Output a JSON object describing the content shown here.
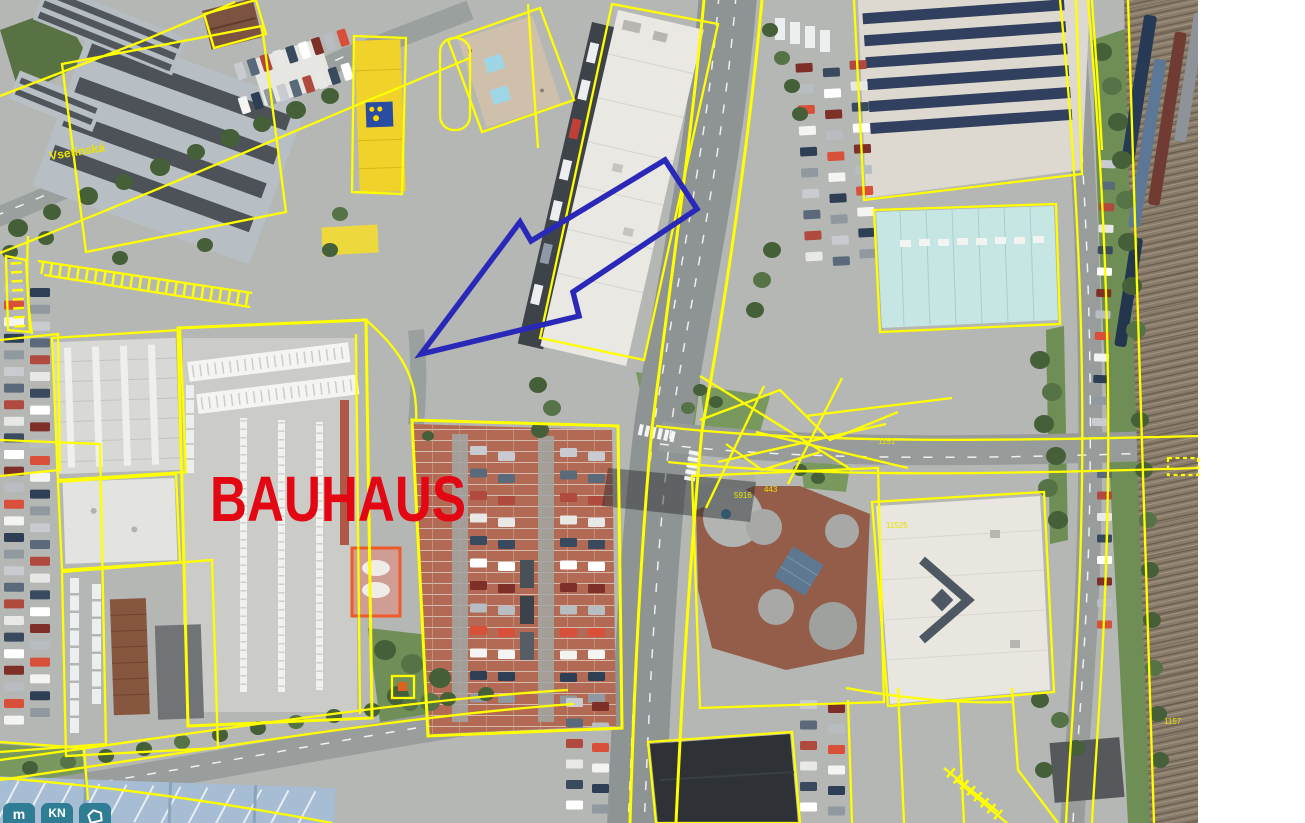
{
  "map": {
    "store_label": "BAUHAUS",
    "street_label": "Vsetínská",
    "parcels": [
      {
        "t": "1151"
      },
      {
        "t": "11525"
      },
      {
        "t": "1157"
      },
      {
        "t": "5916"
      },
      {
        "t": "443"
      }
    ],
    "selection": {
      "points": "421,354 520,222 531,241 665,160 697,209 573,292 579,316"
    }
  },
  "toolbar": {
    "measure_label": "m",
    "cadastre_label": "KN",
    "polygon_icon": "polygon-icon"
  },
  "colors": {
    "cadastral_line": "#ffff00",
    "selection_outline": "#2a28b8",
    "store_label_color": "#e30613",
    "street_label_color": "#e8e200",
    "parcel_label_color": "#e8e200",
    "button_bg": "#2e7d95",
    "button_fg": "#ffffff",
    "car_palette": [
      "#b8bdc2",
      "#d9503a",
      "#f4f4f2",
      "#2e3e55",
      "#9098a0",
      "#c8ccd0",
      "#5b6a7a",
      "#b04a3e",
      "#e8e8e6",
      "#394a5e",
      "#ffffff",
      "#7d2f28"
    ]
  }
}
